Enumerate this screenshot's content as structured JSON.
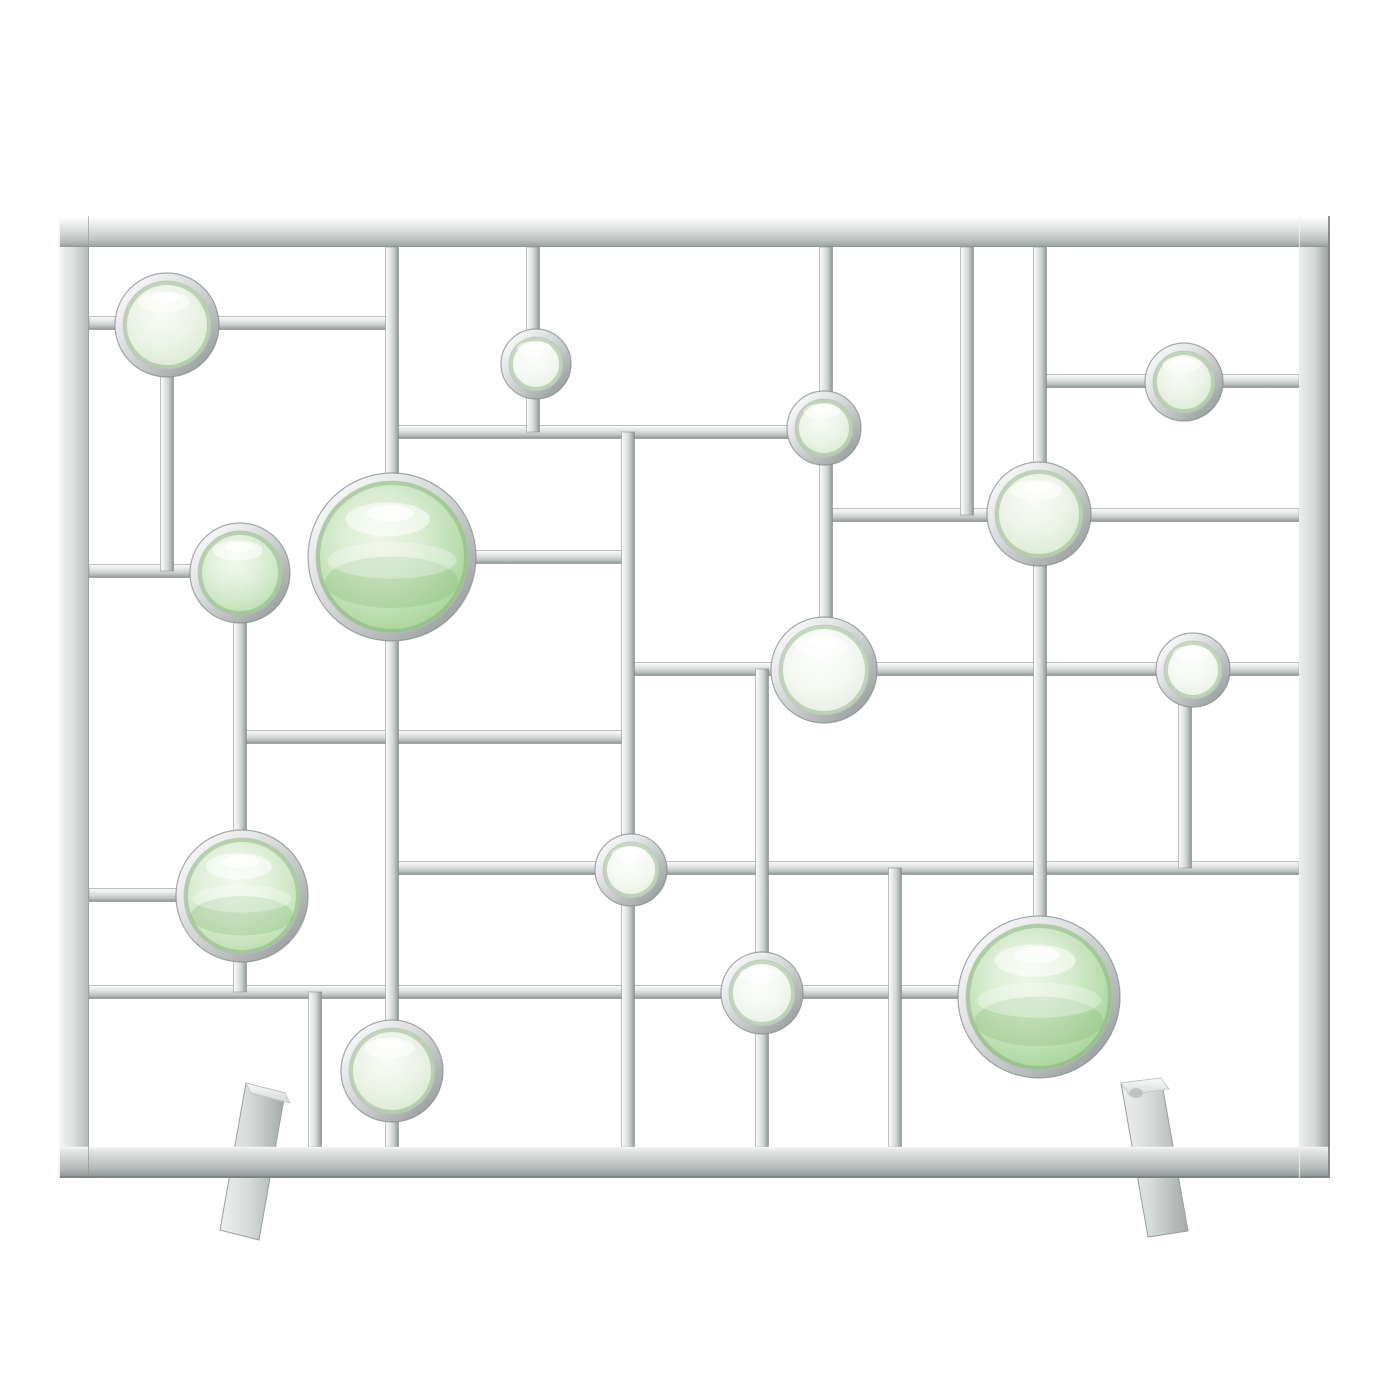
{
  "image": {
    "type": "product-photo",
    "subject": "modern-fireplace-screen",
    "description": "Polished nickel rectangular fire screen with an asymmetric geometric grid holding round green glass lenses, standing on two beam feet against a white seamless background",
    "background_color": "#ffffff"
  },
  "palette": {
    "metal_highlight": "#fbfcfb",
    "metal_light": "#eceeed",
    "metal_mid": "#d3d6d5",
    "metal_shadow": "#9aa09f",
    "metal_edge": "#7c8382",
    "glass_green_strong": "#a9d49c",
    "glass_green_mid": "#cfe8c6",
    "glass_green_pale": "#e6f1e1",
    "glass_white": "#f4f8f2"
  },
  "screen": {
    "frame": {
      "x": 58,
      "y": 216,
      "width": 1272,
      "height": 962,
      "thickness": 31
    },
    "bar_thickness": 13,
    "horizontal_bars": [
      {
        "y": 323,
        "x1": 89,
        "x2": 167
      },
      {
        "y": 323,
        "x1": 167,
        "x2": 391
      },
      {
        "y": 432,
        "x1": 391,
        "x2": 824
      },
      {
        "y": 381,
        "x1": 1040,
        "x2": 1299
      },
      {
        "y": 515,
        "x1": 824,
        "x2": 1299
      },
      {
        "y": 669,
        "x1": 628,
        "x2": 1299
      },
      {
        "y": 557,
        "x1": 392,
        "x2": 628
      },
      {
        "y": 571,
        "x1": 89,
        "x2": 240
      },
      {
        "y": 737,
        "x1": 240,
        "x2": 628
      },
      {
        "y": 868,
        "x1": 392,
        "x2": 1299
      },
      {
        "y": 895,
        "x1": 89,
        "x2": 242
      },
      {
        "y": 992,
        "x1": 89,
        "x2": 965
      }
    ],
    "vertical_bars": [
      {
        "x": 392,
        "y1": 247,
        "y2": 1147
      },
      {
        "x": 533,
        "y1": 247,
        "y2": 432
      },
      {
        "x": 826,
        "y1": 247,
        "y2": 670
      },
      {
        "x": 967,
        "y1": 247,
        "y2": 515
      },
      {
        "x": 1040,
        "y1": 247,
        "y2": 997
      },
      {
        "x": 762,
        "y1": 669,
        "y2": 1147
      },
      {
        "x": 895,
        "y1": 868,
        "y2": 1147
      },
      {
        "x": 1185,
        "y1": 670,
        "y2": 868
      },
      {
        "x": 315,
        "y1": 992,
        "y2": 1147
      },
      {
        "x": 167,
        "y1": 323,
        "y2": 571
      },
      {
        "x": 240,
        "y1": 573,
        "y2": 992
      },
      {
        "x": 628,
        "y1": 432,
        "y2": 1147
      }
    ],
    "lenses": [
      {
        "cx": 167,
        "cy": 325,
        "r": 52,
        "tone": "pale",
        "wave": false
      },
      {
        "cx": 536,
        "cy": 364,
        "r": 35,
        "tone": "white",
        "wave": false
      },
      {
        "cx": 824,
        "cy": 428,
        "r": 37,
        "tone": "pale",
        "wave": false
      },
      {
        "cx": 1184,
        "cy": 382,
        "r": 39,
        "tone": "pale",
        "wave": false
      },
      {
        "cx": 1039,
        "cy": 514,
        "r": 52,
        "tone": "pale",
        "wave": false
      },
      {
        "cx": 240,
        "cy": 573,
        "r": 50,
        "tone": "mid",
        "wave": false
      },
      {
        "cx": 392,
        "cy": 557,
        "r": 84,
        "tone": "strong",
        "wave": true
      },
      {
        "cx": 824,
        "cy": 670,
        "r": 53,
        "tone": "white",
        "wave": false
      },
      {
        "cx": 1193,
        "cy": 670,
        "r": 37,
        "tone": "white",
        "wave": false
      },
      {
        "cx": 242,
        "cy": 896,
        "r": 66,
        "tone": "mid",
        "wave": true
      },
      {
        "cx": 631,
        "cy": 870,
        "r": 36,
        "tone": "white",
        "wave": false
      },
      {
        "cx": 762,
        "cy": 993,
        "r": 41,
        "tone": "white",
        "wave": false
      },
      {
        "cx": 1039,
        "cy": 997,
        "r": 81,
        "tone": "strong",
        "wave": true
      },
      {
        "cx": 392,
        "cy": 1071,
        "r": 51,
        "tone": "pale",
        "wave": false
      }
    ],
    "feet": [
      {
        "body": [
          [
            246,
            1083
          ],
          [
            285,
            1093
          ],
          [
            259,
            1240
          ],
          [
            220,
            1230
          ]
        ],
        "top": [
          [
            246,
            1083
          ],
          [
            285,
            1093
          ],
          [
            290,
            1103
          ],
          [
            251,
            1093
          ]
        ],
        "stamp": null
      },
      {
        "body": [
          [
            1121,
            1083
          ],
          [
            1161,
            1078
          ],
          [
            1188,
            1231
          ],
          [
            1148,
            1237
          ]
        ],
        "top": [
          [
            1121,
            1083
          ],
          [
            1161,
            1078
          ],
          [
            1169,
            1089
          ],
          [
            1129,
            1095
          ]
        ],
        "stamp": {
          "cx": 1136,
          "cy": 1093
        }
      }
    ]
  }
}
